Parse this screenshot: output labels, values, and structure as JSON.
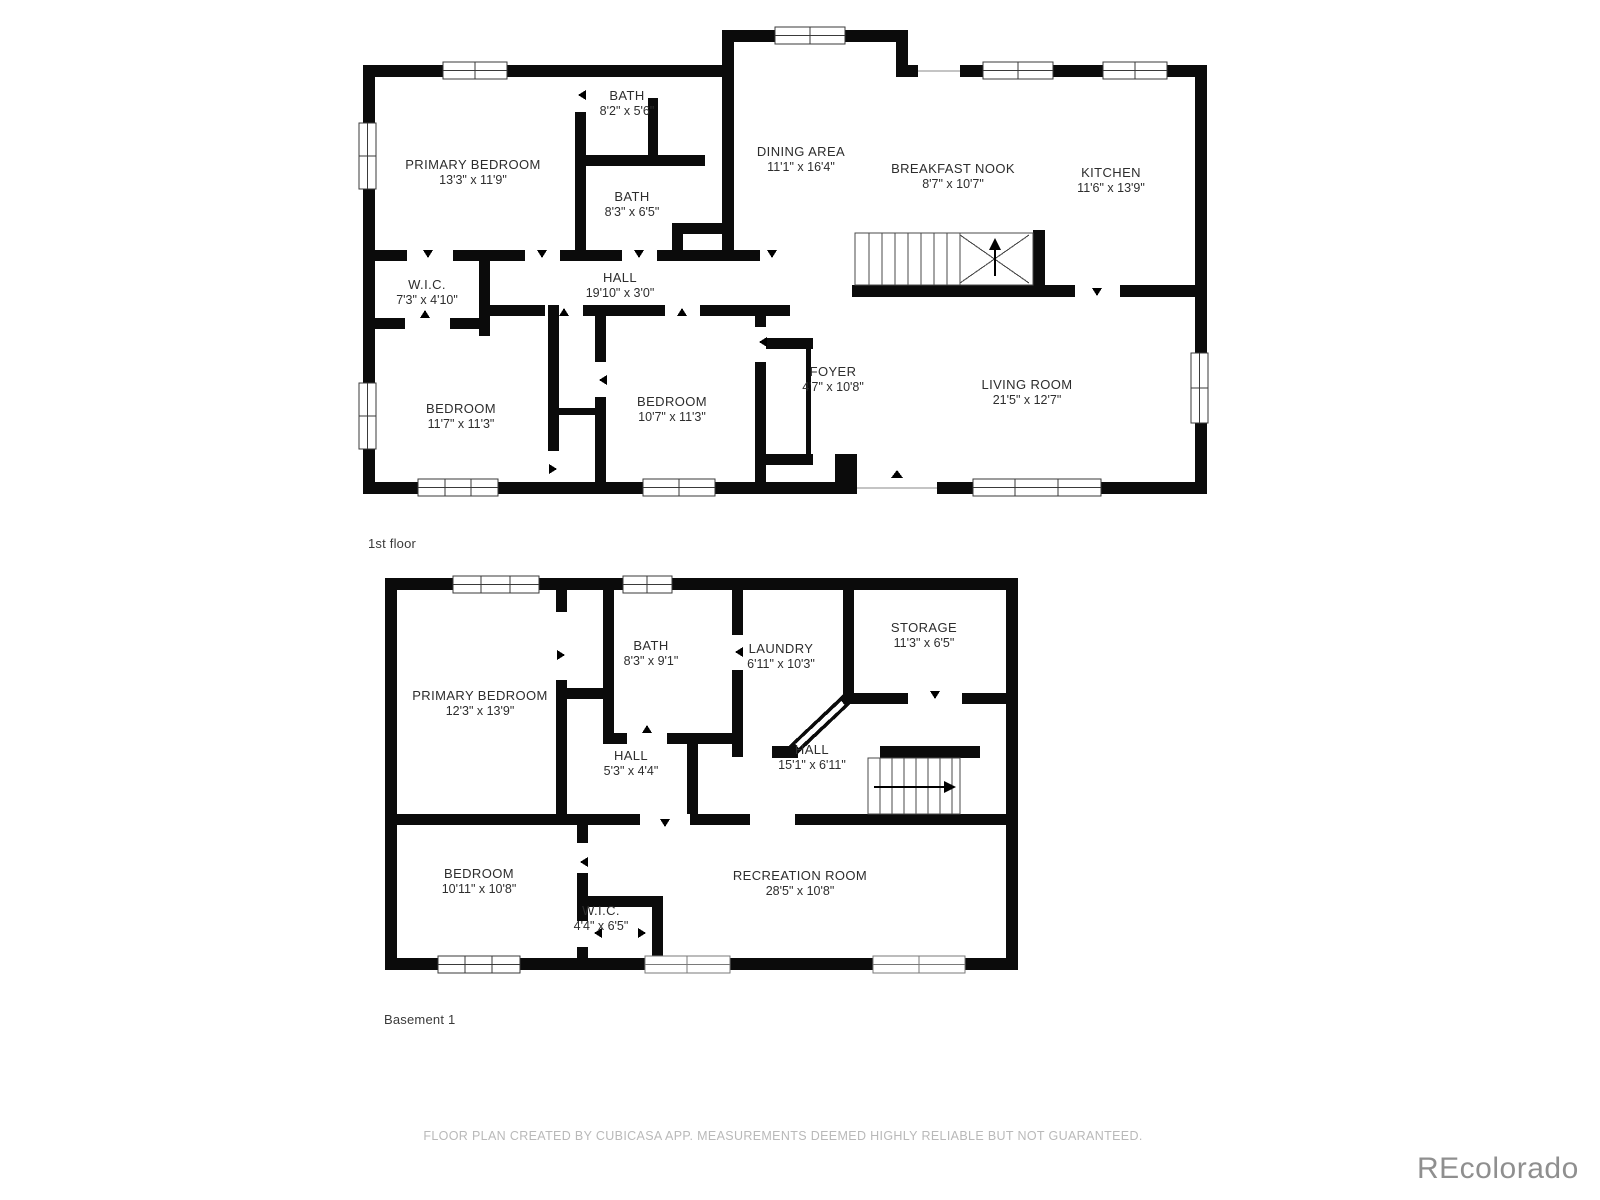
{
  "floors": [
    {
      "label": "1st floor",
      "rooms": [
        {
          "name": "PRIMARY BEDROOM",
          "dims": "13'3\" x 11'9\""
        },
        {
          "name": "BATH",
          "dims": "8'2\" x 5'6\""
        },
        {
          "name": "BATH",
          "dims": "8'3\" x 6'5\""
        },
        {
          "name": "DINING AREA",
          "dims": "11'1\" x 16'4\""
        },
        {
          "name": "BREAKFAST NOOK",
          "dims": "8'7\" x 10'7\""
        },
        {
          "name": "KITCHEN",
          "dims": "11'6\" x 13'9\""
        },
        {
          "name": "W.I.C.",
          "dims": "7'3\" x 4'10\""
        },
        {
          "name": "HALL",
          "dims": "19'10\" x 3'0\""
        },
        {
          "name": "BEDROOM",
          "dims": "11'7\" x 11'3\""
        },
        {
          "name": "BEDROOM",
          "dims": "10'7\" x 11'3\""
        },
        {
          "name": "FOYER",
          "dims": "4'7\" x 10'8\""
        },
        {
          "name": "LIVING ROOM",
          "dims": "21'5\" x 12'7\""
        }
      ]
    },
    {
      "label": "Basement 1",
      "rooms": [
        {
          "name": "PRIMARY BEDROOM",
          "dims": "12'3\" x 13'9\""
        },
        {
          "name": "BATH",
          "dims": "8'3\" x 9'1\""
        },
        {
          "name": "LAUNDRY",
          "dims": "6'11\" x 10'3\""
        },
        {
          "name": "STORAGE",
          "dims": "11'3\" x 6'5\""
        },
        {
          "name": "HALL",
          "dims": "5'3\" x 4'4\""
        },
        {
          "name": "HALL",
          "dims": "15'1\" x 6'11\""
        },
        {
          "name": "BEDROOM",
          "dims": "10'11\" x 10'8\""
        },
        {
          "name": "W.I.C.",
          "dims": "4'4\" x 6'5\""
        },
        {
          "name": "RECREATION ROOM",
          "dims": "28'5\" x 10'8\""
        }
      ]
    }
  ],
  "footer": {
    "disclaimer": "FLOOR PLAN CREATED BY CUBICASA APP. MEASUREMENTS DEEMED HIGHLY RELIABLE BUT NOT GUARANTEED."
  },
  "watermark": "REcolorado"
}
